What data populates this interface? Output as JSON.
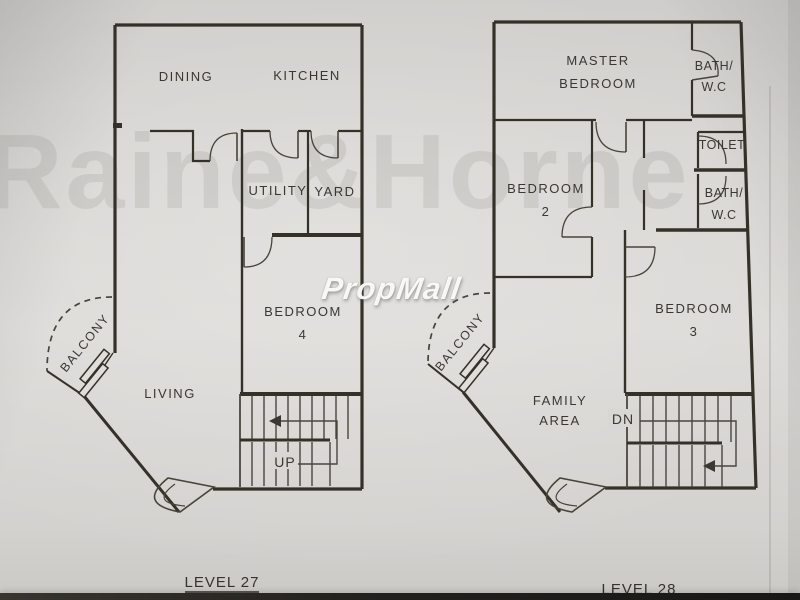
{
  "watermarks": {
    "agency": "Raine&Horne",
    "portal": "PropMall"
  },
  "plan_level_27": {
    "caption": "LEVEL 27",
    "rooms": {
      "dining": "DINING",
      "kitchen": "KITCHEN",
      "utility": "UTILITY",
      "yard": "YARD",
      "bedroom4_line1": "BEDROOM",
      "bedroom4_line2": "4",
      "living": "LIVING",
      "balcony": "BALCONY",
      "stair_direction": "UP"
    }
  },
  "plan_level_28": {
    "caption": "LEVEL 28",
    "rooms": {
      "master_line1": "MASTER",
      "master_line2": "BEDROOM",
      "bath_top_line1": "BATH/",
      "bath_top_line2": "W.C",
      "toilet": "TOILET",
      "bath_mid_line1": "BATH/",
      "bath_mid_line2": "W.C",
      "bedroom2_line1": "BEDROOM",
      "bedroom2_line2": "2",
      "bedroom3_line1": "BEDROOM",
      "bedroom3_line2": "3",
      "family_line1": "FAMILY",
      "family_line2": "AREA",
      "balcony": "BALCONY",
      "stair_direction": "DN"
    }
  }
}
